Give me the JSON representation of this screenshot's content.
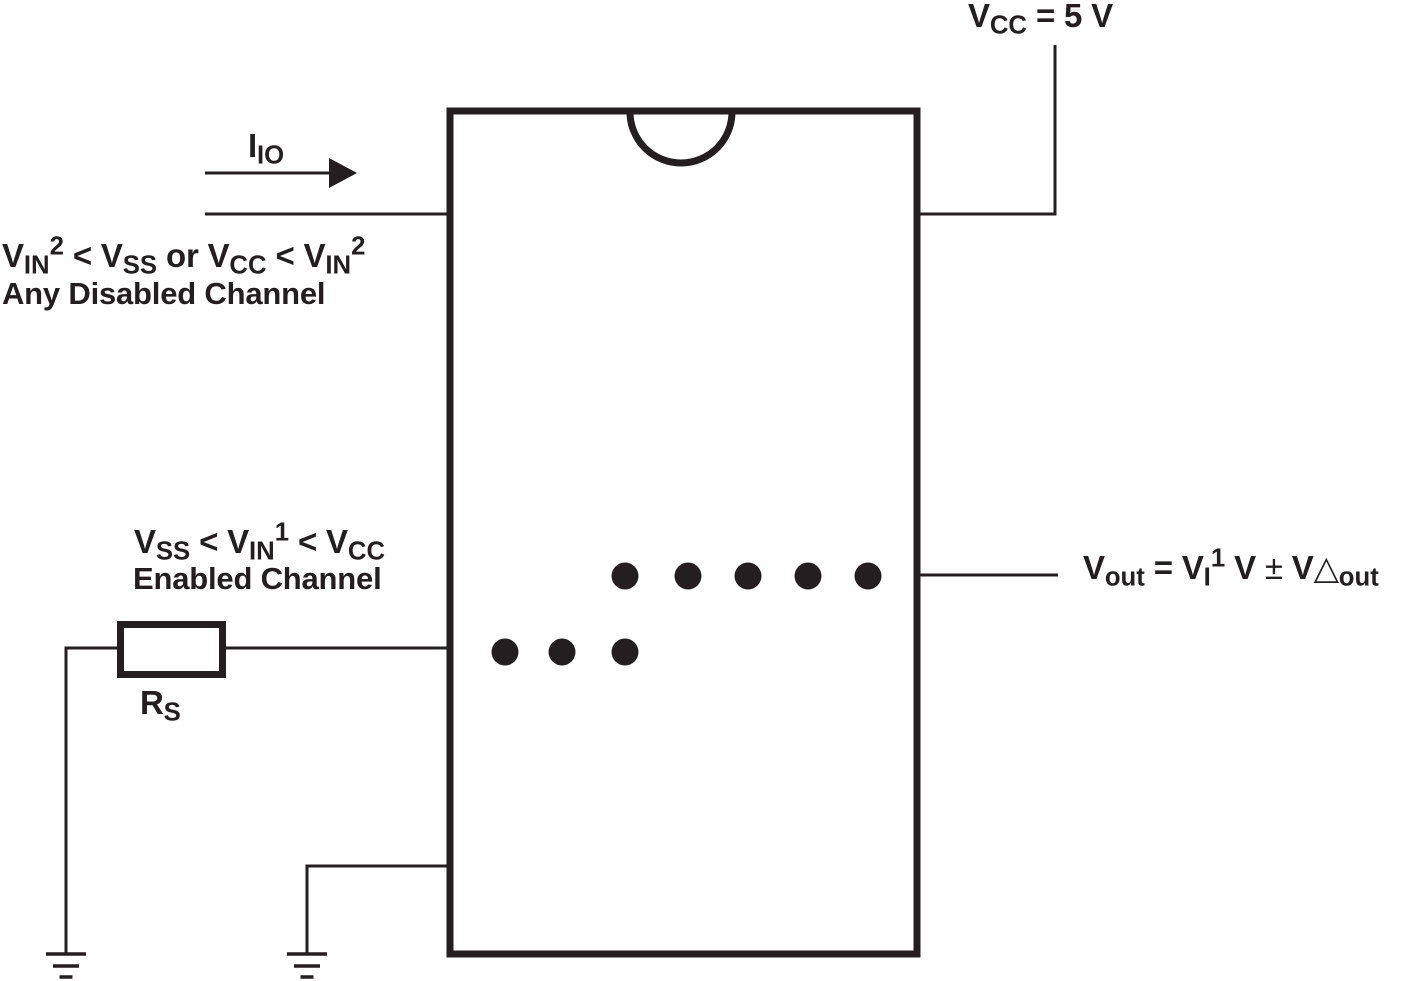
{
  "colors": {
    "ink": "#231f20",
    "background": "#ffffff"
  },
  "supply": {
    "label": [
      {
        "t": "V",
        "s": "n"
      },
      {
        "t": "CC",
        "s": "sub"
      },
      {
        "t": " = 5 V",
        "s": "n"
      }
    ]
  },
  "io_current": {
    "label": [
      {
        "t": "I",
        "s": "n"
      },
      {
        "t": "IO",
        "s": "sub"
      }
    ]
  },
  "disabled_channel": {
    "condition": [
      {
        "t": "V",
        "s": "n"
      },
      {
        "t": "IN",
        "s": "sub"
      },
      {
        "t": "2",
        "s": "sup"
      },
      {
        "t": " < V",
        "s": "n"
      },
      {
        "t": "SS",
        "s": "sub"
      },
      {
        "t": " or V",
        "s": "n"
      },
      {
        "t": "CC",
        "s": "sub"
      },
      {
        "t": " < V",
        "s": "n"
      },
      {
        "t": "IN",
        "s": "sub"
      },
      {
        "t": "2",
        "s": "sup"
      }
    ],
    "caption": "Any Disabled Channel"
  },
  "enabled_channel": {
    "condition": [
      {
        "t": "V",
        "s": "n"
      },
      {
        "t": "SS",
        "s": "sub"
      },
      {
        "t": " < V",
        "s": "n"
      },
      {
        "t": "IN",
        "s": "sub"
      },
      {
        "t": "1",
        "s": "sup"
      },
      {
        "t": " < V",
        "s": "n"
      },
      {
        "t": "CC",
        "s": "sub"
      }
    ],
    "caption": "Enabled Channel"
  },
  "source_resistor": {
    "label": [
      {
        "t": "R",
        "s": "n"
      },
      {
        "t": "S",
        "s": "sub"
      }
    ]
  },
  "output": {
    "label": [
      {
        "t": "V",
        "s": "n"
      },
      {
        "t": "out",
        "s": "sub"
      },
      {
        "t": " = V",
        "s": "n"
      },
      {
        "t": "I",
        "s": "sub"
      },
      {
        "t": "1",
        "s": "sup"
      },
      {
        "t": " V ",
        "s": "n"
      },
      {
        "t": "±",
        "s": "sym"
      },
      {
        "t": " V",
        "s": "n"
      },
      {
        "t": "△",
        "s": "sym"
      },
      {
        "t": "out",
        "s": "sub"
      }
    ]
  }
}
